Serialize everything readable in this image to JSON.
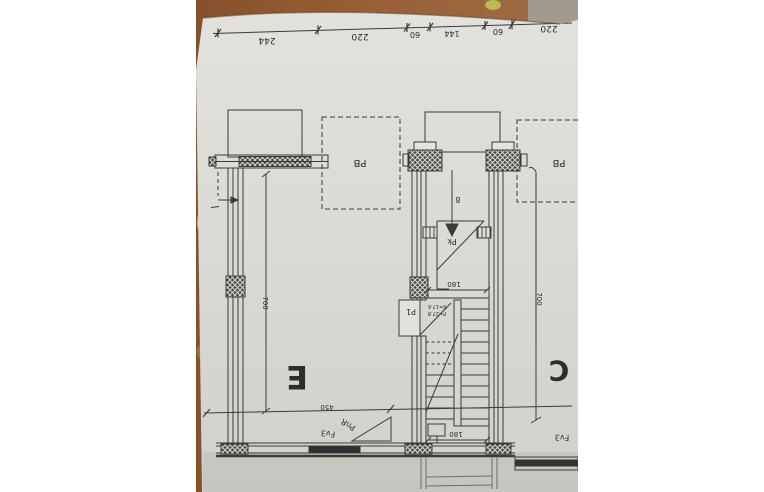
{
  "scene": {
    "description": "photo-of-floor-plan-upside-down",
    "colors": {
      "letterbox": "#ffffff",
      "table_brown": "#93582f",
      "table_brown_dark": "#7a4524",
      "table_gray": "#a39a8f",
      "paper": "#dedcd7",
      "paper_dark": "#cfcdc8",
      "ink": "#3a3a3a",
      "blob_yellow": "#bdb952"
    }
  },
  "plan": {
    "top_dimensions": [
      "244",
      "220",
      "60",
      "144",
      "60",
      "220"
    ],
    "rooms": {
      "left": "E",
      "right": "C"
    },
    "boxes": {
      "pb_left": "PB",
      "pb_right": "PB"
    },
    "doors": {
      "stair_door": "P1",
      "upper_door": "Pk"
    },
    "stair": {
      "arrow_label": "8",
      "note_line1": "6=17.6",
      "note_line2": "P=27.8",
      "width_top": "180",
      "width_bottom": "180"
    },
    "dimensions": {
      "left_height": "700",
      "right_height": "700",
      "bottom_width": "450"
    },
    "labels": {
      "pnr": "PnR",
      "fv3_left": "Fv3",
      "fv3_right": "Fv3"
    }
  }
}
